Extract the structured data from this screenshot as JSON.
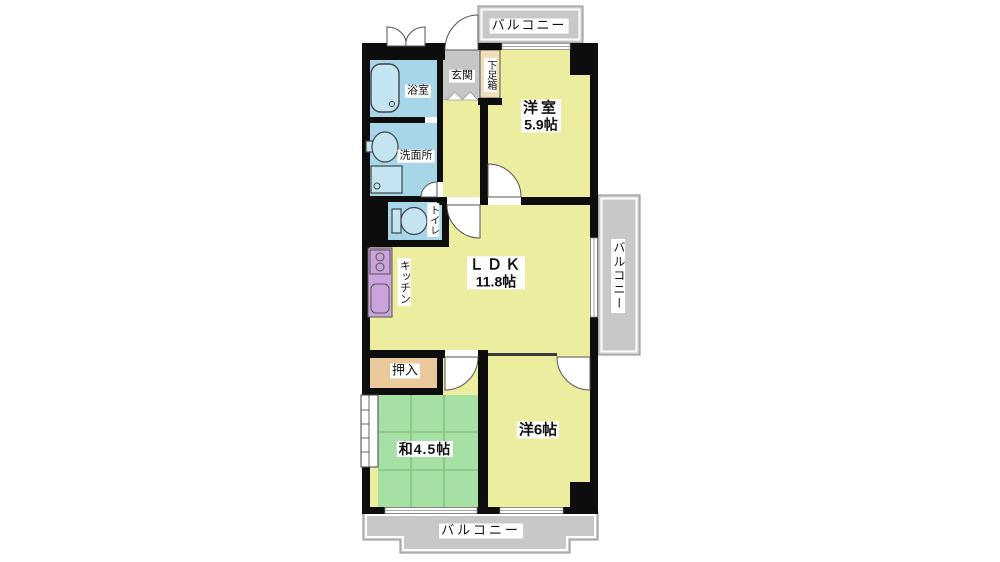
{
  "rooms": {
    "western_room_59": {
      "label": "洋室",
      "size": "5.9帖"
    },
    "ldk": {
      "label": "ＬＤＫ",
      "size": "11.8帖"
    },
    "western_room_6": {
      "label": "洋6帖"
    },
    "japanese_room": {
      "label": "和4.5帖"
    },
    "bathroom": {
      "label": "浴室"
    },
    "washroom": {
      "label": "洗面所"
    },
    "toilet": {
      "label": "トイレ"
    },
    "kitchen": {
      "label": "キッチン"
    },
    "entrance": {
      "label": "玄関"
    },
    "shoe_box": {
      "label": "下足箱"
    },
    "closet": {
      "label": "押入"
    }
  },
  "balconies": {
    "top": {
      "label": "バルコニー"
    },
    "right": {
      "label": "バルコニー"
    },
    "bottom": {
      "label": "バルコニー"
    }
  },
  "colors": {
    "room_yellow": "#EDEDA0",
    "tatami_green": "#A7E0A4",
    "water_blue": "#A6D6E8",
    "fixture_blue": "#C3E4F0",
    "balcony_gray": "#C8C8C8",
    "entrance_gray": "#C6C6C6",
    "shoe_box_tan": "#F0E0BA",
    "closet_tan": "#EBC99C",
    "kitchen_purple": "#CBA3DC",
    "wall_black": "#0D0D0D"
  }
}
